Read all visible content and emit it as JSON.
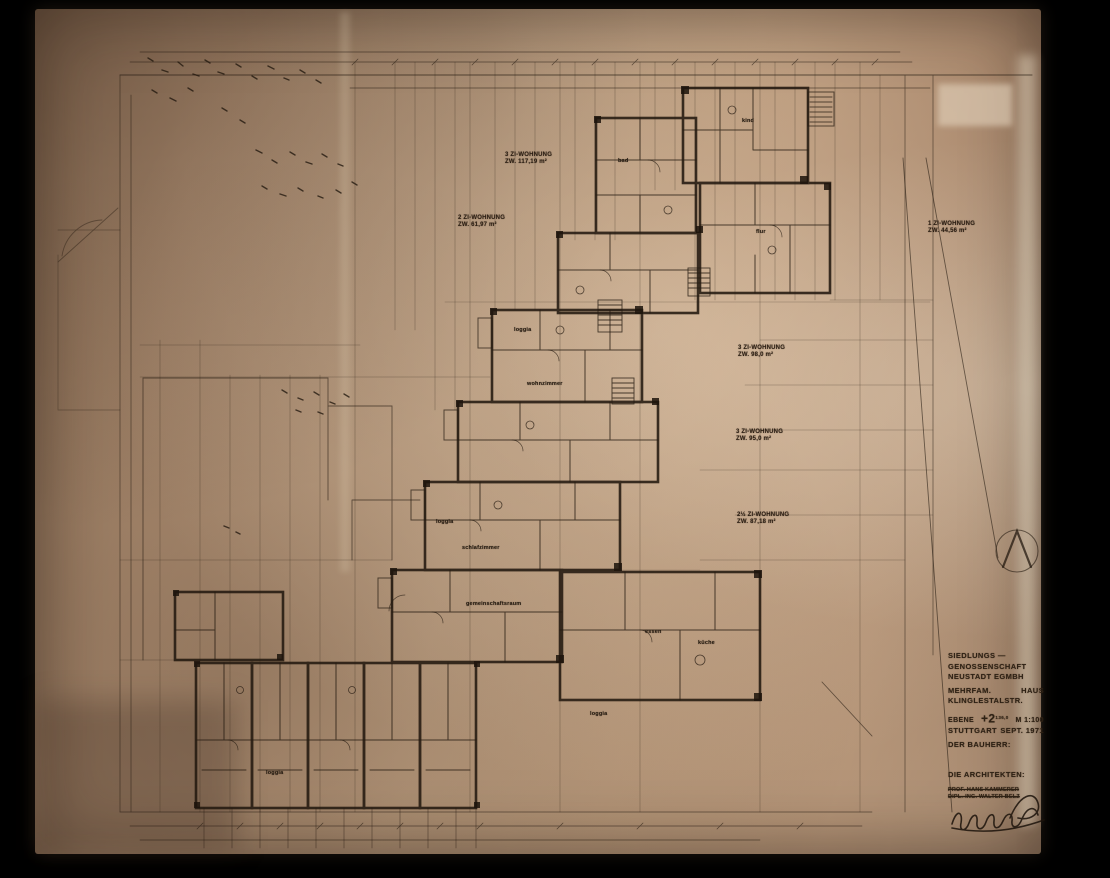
{
  "colors": {
    "background": "#000000",
    "paper_mid": "#c1a283",
    "paper_dark": "#8f715a",
    "ink": "#241a10"
  },
  "plan": {
    "apartment_labels": [
      {
        "line1": "3 ZI-WOHNUNG",
        "line2": "ZW. 117,19 m²"
      },
      {
        "line1": "2 ZI-WOHNUNG",
        "line2": "ZW. 61,97 m²"
      },
      {
        "line1": "1 ZI-WOHNUNG",
        "line2": "ZW. 44,56 m²"
      },
      {
        "line1": "3 ZI-WOHNUNG",
        "line2": "ZW. 98,0 m²"
      },
      {
        "line1": "3 ZI-WOHNUNG",
        "line2": "ZW. 95,0 m²"
      },
      {
        "line1": "2½ ZI-WOHNUNG",
        "line2": "ZW. 87,18 m²"
      }
    ],
    "room_labels": [
      "loggia",
      "bad",
      "kind",
      "flur",
      "küche",
      "essen",
      "wohnzimmer",
      "schlafzimmer",
      "gemeinschaftsraum",
      "loggia",
      "loggia",
      "loggia"
    ]
  },
  "title_block": {
    "client_line1": "SIEDLUNGS —",
    "client_line2": "GENOSSENSCHAFT",
    "client_line3": "NEUSTADT EGMBH",
    "project_line1a": "MEHRFAM.",
    "project_line1b": "HAUS",
    "project_line2": "KLINGLESTALSTR.",
    "level_label": "EBENE",
    "level_value": "+2",
    "level_elevation": "136,0",
    "scale": "M 1:100",
    "city": "STUTTGART",
    "date": "SEPT. 1971",
    "bauherr_label": "DER BAUHERR:",
    "architects_label": "DIE ARCHITEKTEN:",
    "architect1": "PROF. HANS KAMMERER",
    "architect2": "DIPL.-ING. WALTER BELZ"
  }
}
